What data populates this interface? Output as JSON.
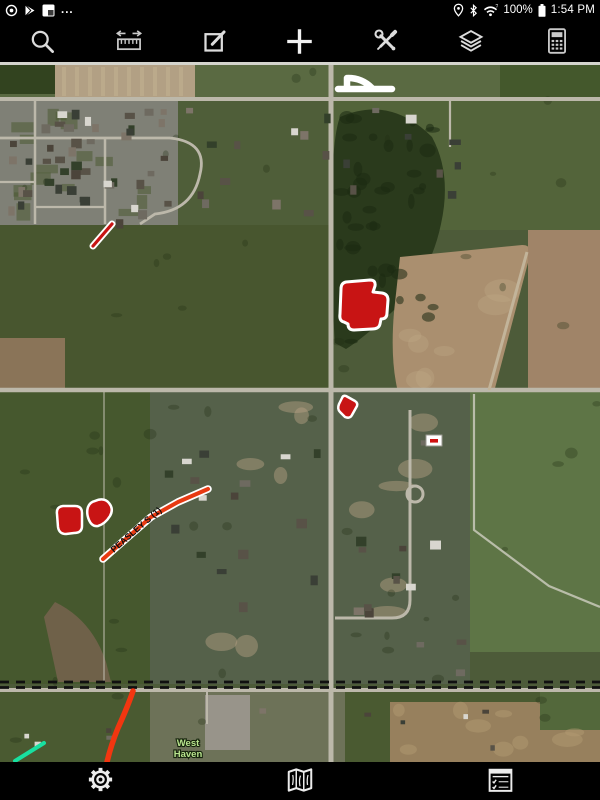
{
  "status_bar": {
    "time": "1:54 PM",
    "battery_percent": "100%",
    "overflow_text": "...",
    "left_icons": [
      "record-icon",
      "play-icon",
      "app-notification-icon",
      "overflow-dots"
    ],
    "right_icons": [
      "location-icon",
      "bluetooth-icon",
      "wifi-icon",
      "battery-icon"
    ]
  },
  "toolbar": {
    "items": [
      {
        "name": "search"
      },
      {
        "name": "measure"
      },
      {
        "name": "draw"
      },
      {
        "name": "add"
      },
      {
        "name": "tools"
      },
      {
        "name": "layers"
      },
      {
        "name": "calculator"
      }
    ]
  },
  "bottom_bar": {
    "items": [
      {
        "name": "settings"
      },
      {
        "name": "map"
      },
      {
        "name": "forms"
      }
    ]
  },
  "map": {
    "road_label": {
      "text": "PEASLEY S (1)",
      "color": "#0d0d0d"
    },
    "place_label": {
      "line1": "West",
      "line2": "Haven",
      "fill": "#b9e48e",
      "halo": "#15230c"
    },
    "colors": {
      "annotation_fill": "#c81414",
      "annotation_outline": "#ffffff",
      "track_color": "#f23610",
      "trail_color": "#18e0a0"
    },
    "annotations": [
      {
        "name": "drawn-shape-white",
        "d": "M347,16 L347,27 M348,16 Q362,16 372,26 M338,27 L392,27",
        "stroke": "#ffffff",
        "width": 6.5,
        "fill": "none"
      },
      {
        "name": "field-polygon-large",
        "d": "M346,220 L370,218 Q376,218 375,224 L373,230 L382,231 Q388,232 388,238 L387,251 Q387,257 381,257 L380,262 Q379,267 372,267 L354,268 Q348,268 348,262 L344,260 Q339,259 340,252 L341,227 Q341,221 346,220 Z",
        "stroke": "#ffffff",
        "width": 3,
        "fill": "#c81414"
      },
      {
        "name": "field-polygon-small",
        "d": "M346,334 L355,339 Q358,341 357,344 L352,353 Q350,357 345,355 L340,350 Q337,347 339,342 L342,336 Q343,333 346,334 Z",
        "stroke": "#ffffff",
        "width": 2.5,
        "fill": "#c81414"
      },
      {
        "name": "field-polygon-left",
        "d": "M63,444 L75,444 Q82,444 82,451 L82,464 Q82,471 74,471 L66,472 Q59,472 58,465 L57,452 Q56,445 63,444 Z",
        "stroke": "#ffffff",
        "width": 2.5,
        "fill": "#c81414"
      },
      {
        "name": "field-polygon-heart",
        "d": "M95,439 Q104,435 109,441 Q114,447 110,454 Q105,462 98,464 Q92,465 89,458 Q86,451 88,445 Q90,440 95,439 Z",
        "stroke": "#ffffff",
        "width": 2.5,
        "fill": "#c81414"
      },
      {
        "name": "road-segment-peasley",
        "d": "M103,497 L128,475 L151,455 L178,440 L208,427",
        "stroke": "#e83a12",
        "width": 4,
        "fill": "none",
        "casing": "#ffffff",
        "casing_width": 7.5
      },
      {
        "name": "drawn-line-short",
        "d": "M93,184 L112,162",
        "stroke": "#c81414",
        "width": 3.2,
        "fill": "none",
        "casing": "#ffffff",
        "casing_width": 7
      },
      {
        "name": "track-line-red",
        "d": "M133,629 Q128,644 118,666 Q111,683 107,700",
        "stroke": "#f23610",
        "width": 5.5,
        "fill": "none"
      },
      {
        "name": "trail-line-cyan",
        "d": "M15,699 L44,681",
        "stroke": "#18e0a0",
        "width": 4,
        "fill": "none"
      },
      {
        "name": "map-marker-box",
        "d": "M426,373 h16 v11 h-16 Z",
        "stroke": "#999990",
        "width": 1,
        "fill": "#ffffff"
      },
      {
        "name": "map-marker-bar",
        "d": "M430,377 h8 v3.6 h-8 Z",
        "fill": "#d01010"
      }
    ]
  }
}
